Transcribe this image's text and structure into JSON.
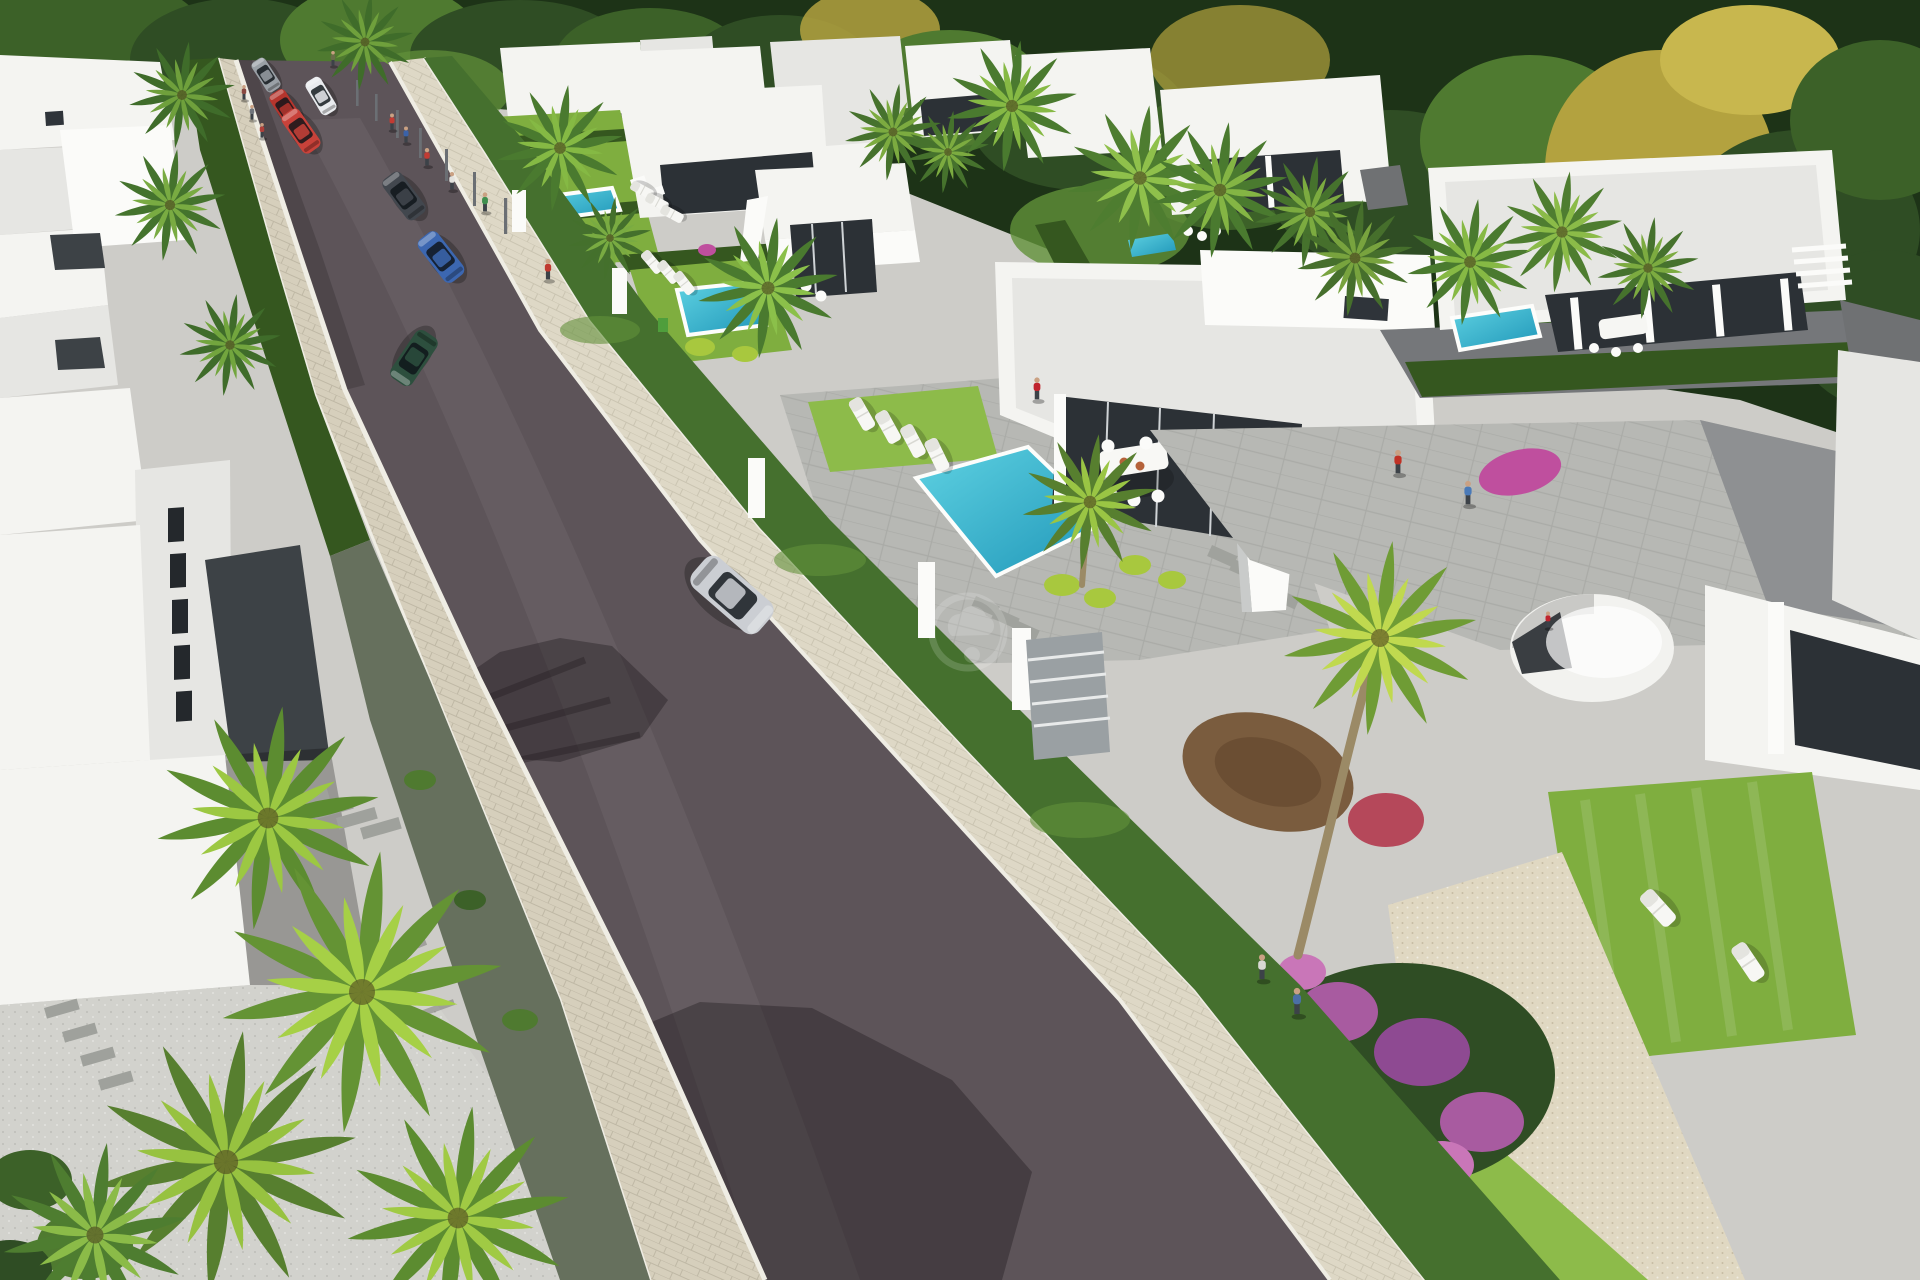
{
  "image": {
    "kind": "architectural-3d-render",
    "description": "Aerial rendering of a modern white villa development: diagonal street with cars and pedestrians, hedge-fenced lots with turquoise pools, sun loungers, palm trees, forest backdrop, faint circular watermark in center"
  },
  "palette": {
    "ground": "#cdccc8",
    "road": "#5d5459",
    "curb": "#efede4",
    "cobble": "#d6cfbc",
    "cobble-light": "#ded8c6",
    "white": "#f4f4f1",
    "white-hi": "#fbfbf9",
    "white-dim": "#e6e6e3",
    "glass": "#2c3136",
    "dark-court": "#3d4246",
    "mullion": "#cfd3d6",
    "hedge": "#45702e",
    "hedge-dark": "#35571f",
    "lawn": "#7fae3f",
    "lawn-bright": "#8dbb4a",
    "lime": "#a8c83e",
    "pool-top": "#5fd2e2",
    "pool-deep": "#1f96b8",
    "pool-coping": "#fdfdfb",
    "stone": "#66705d",
    "patio": "#b7b8b4",
    "gravel": "#e0d8c2",
    "dirt": "#7a5c3e",
    "trunk": "#9b8a66",
    "forest-1": "#1d3317",
    "forest-2": "#2f4d24",
    "forest-3": "#3c6128",
    "forest-4": "#4f7a30",
    "forest-5": "#62913a",
    "autumn-1": "#b3a23f",
    "autumn-2": "#c8b74e",
    "flower-purple": "#a85ba0",
    "flower-magenta": "#bf4f9e",
    "flower-pink": "#c976b8",
    "shadow": "rgba(25,20,24,0.35)",
    "watermark": "rgba(255,255,255,0.16)"
  },
  "scene": {
    "sprites": [
      {
        "n": "palm-tree",
        "s": "palm",
        "x": 365,
        "y": 42,
        "k": 1.0,
        "c1": "#3f6c2a",
        "c2": "#6fa03c"
      },
      {
        "n": "palm-tree",
        "s": "palm",
        "x": 182,
        "y": 95,
        "k": 1.1,
        "c1": "#3f6c2a",
        "c2": "#6fa03c"
      },
      {
        "n": "palm-tree",
        "s": "palm",
        "x": 170,
        "y": 205,
        "k": 1.15,
        "c1": "#44732d",
        "c2": "#79ab42"
      },
      {
        "n": "palm-tree",
        "s": "palm",
        "x": 230,
        "y": 345,
        "k": 1.05,
        "c1": "#3f6c2a",
        "c2": "#72a53e"
      },
      {
        "n": "palm-tree",
        "s": "palm",
        "x": 560,
        "y": 148,
        "k": 1.3,
        "c1": "#4a7a2f",
        "c2": "#85b944"
      },
      {
        "n": "palm-tree",
        "s": "palm",
        "x": 610,
        "y": 238,
        "k": 0.85,
        "c1": "#44702c",
        "c2": "#79ab42"
      },
      {
        "n": "palm-tree",
        "s": "palm",
        "x": 768,
        "y": 288,
        "k": 1.45,
        "c1": "#4a7a2f",
        "c2": "#8bc04a"
      },
      {
        "n": "palm-tree",
        "s": "palm",
        "x": 893,
        "y": 132,
        "k": 1.0,
        "c1": "#46722d",
        "c2": "#7cab40"
      },
      {
        "n": "palm-tree",
        "s": "palm",
        "x": 948,
        "y": 152,
        "k": 0.85,
        "c1": "#46722d",
        "c2": "#7cab40"
      },
      {
        "n": "palm-tree",
        "s": "palm",
        "x": 1012,
        "y": 106,
        "k": 1.35,
        "c1": "#4a7a2f",
        "c2": "#86b944"
      },
      {
        "n": "palm-tree",
        "s": "palm",
        "x": 1140,
        "y": 178,
        "k": 1.5,
        "c1": "#4e7d30",
        "c2": "#8fc04b"
      },
      {
        "n": "palm-tree",
        "s": "palm",
        "x": 1220,
        "y": 190,
        "k": 1.4,
        "c1": "#4a7a2f",
        "c2": "#84b544"
      },
      {
        "n": "palm-tree",
        "s": "palm",
        "x": 1310,
        "y": 212,
        "k": 1.15,
        "c1": "#46722d",
        "c2": "#7cab40"
      },
      {
        "n": "palm-tree",
        "s": "palm",
        "x": 1355,
        "y": 258,
        "k": 1.2,
        "c1": "#466f2c",
        "c2": "#78a33e"
      },
      {
        "n": "palm-tree",
        "s": "palm",
        "x": 1470,
        "y": 262,
        "k": 1.3,
        "c1": "#4a7a2f",
        "c2": "#86b944"
      },
      {
        "n": "palm-tree",
        "s": "palm",
        "x": 1562,
        "y": 232,
        "k": 1.25,
        "c1": "#4e7d30",
        "c2": "#8bbb48"
      },
      {
        "n": "palm-tree",
        "s": "palm",
        "x": 1648,
        "y": 268,
        "k": 1.05,
        "c1": "#46722d",
        "c2": "#7cab40"
      },
      {
        "n": "palm-tree",
        "s": "palm",
        "x": 1090,
        "y": 502,
        "k": 1.4,
        "c1": "#577f2f",
        "c2": "#9ac544"
      },
      {
        "n": "palm-tree",
        "s": "palm",
        "x": 1380,
        "y": 638,
        "k": 2.0,
        "c1": "#6f9c35",
        "c2": "#c0d94f"
      },
      {
        "n": "palm-tree",
        "s": "palm",
        "x": 268,
        "y": 818,
        "k": 2.3,
        "c1": "#5c8c30",
        "c2": "#9cc842"
      },
      {
        "n": "palm-tree",
        "s": "palm",
        "x": 362,
        "y": 992,
        "k": 2.9,
        "c1": "#649334",
        "c2": "#a6d046"
      },
      {
        "n": "palm-tree",
        "s": "palm",
        "x": 226,
        "y": 1162,
        "k": 2.7,
        "c1": "#577f2f",
        "c2": "#97c240"
      },
      {
        "n": "palm-tree",
        "s": "palm",
        "x": 458,
        "y": 1218,
        "k": 2.3,
        "c1": "#5c8c30",
        "c2": "#a0ca44"
      },
      {
        "n": "palm-tree",
        "s": "palm",
        "x": 95,
        "y": 1235,
        "k": 1.9,
        "c1": "#4e7d30",
        "c2": "#8bbb48"
      },
      {
        "n": "car-gray",
        "s": "car",
        "x": 266,
        "y": 75,
        "r": -33,
        "k": 0.42,
        "c1": "#9aa0a6"
      },
      {
        "n": "car-red-sedan",
        "s": "car",
        "x": 286,
        "y": 109,
        "r": -33,
        "k": 0.48,
        "c1": "#b5352d"
      },
      {
        "n": "car-red-suv",
        "s": "car",
        "x": 301,
        "y": 131,
        "r": -35,
        "k": 0.55,
        "c1": "#c8423a"
      },
      {
        "n": "car-white",
        "s": "car",
        "x": 321,
        "y": 96,
        "r": -31,
        "k": 0.46,
        "c1": "#e9ebee"
      },
      {
        "n": "car-dark-gray",
        "s": "car",
        "x": 404,
        "y": 196,
        "r": -37,
        "k": 0.6,
        "c1": "#42474e"
      },
      {
        "n": "car-blue",
        "s": "car",
        "x": 441,
        "y": 257,
        "r": -38,
        "k": 0.64,
        "c1": "#3c67b1"
      },
      {
        "n": "car-green-convertible",
        "s": "car",
        "x": 414,
        "y": 358,
        "r": 214,
        "k": 0.68,
        "c1": "#2d4f3e"
      },
      {
        "n": "car-silver-suv",
        "s": "car",
        "x": 732,
        "y": 595,
        "r": 131,
        "k": 1.05,
        "c1": "#cbced3"
      },
      {
        "n": "pedestrian",
        "s": "person",
        "x": 333,
        "y": 66,
        "k": 0.5,
        "c1": "#6a6d4a"
      },
      {
        "n": "pedestrian",
        "s": "person",
        "x": 244,
        "y": 100,
        "k": 0.5,
        "c1": "#8a4a42"
      },
      {
        "n": "pedestrian",
        "s": "person",
        "x": 252,
        "y": 120,
        "k": 0.5,
        "c1": "#70757c"
      },
      {
        "n": "pedestrian",
        "s": "person",
        "x": 262,
        "y": 138,
        "k": 0.5,
        "c1": "#b0403a"
      },
      {
        "n": "pedestrian",
        "s": "person",
        "x": 392,
        "y": 130,
        "k": 0.55,
        "c1": "#c23b33"
      },
      {
        "n": "pedestrian",
        "s": "person",
        "x": 406,
        "y": 143,
        "k": 0.55,
        "c1": "#3b62a8"
      },
      {
        "n": "pedestrian",
        "s": "person",
        "x": 427,
        "y": 166,
        "k": 0.6,
        "c1": "#c23b33"
      },
      {
        "n": "pedestrian",
        "s": "person",
        "x": 452,
        "y": 190,
        "k": 0.6,
        "c1": "#e2e2de"
      },
      {
        "n": "pedestrian",
        "s": "person",
        "x": 485,
        "y": 212,
        "k": 0.65,
        "c1": "#3f8f4e"
      },
      {
        "n": "pedestrian",
        "s": "person",
        "x": 548,
        "y": 280,
        "k": 0.7,
        "c1": "#c0392f"
      },
      {
        "n": "woman-by-pool",
        "s": "person",
        "x": 1037,
        "y": 400,
        "k": 0.75,
        "c1": "#c0242e"
      },
      {
        "n": "man-red-shirt",
        "s": "person",
        "x": 1398,
        "y": 474,
        "k": 0.8,
        "c1": "#c03226"
      },
      {
        "n": "man-blue-shirt",
        "s": "person",
        "x": 1468,
        "y": 505,
        "k": 0.8,
        "c1": "#4a7ab8"
      },
      {
        "n": "figure-in-dome",
        "s": "person",
        "x": 1548,
        "y": 628,
        "k": 0.55,
        "c1": "#c0242e"
      },
      {
        "n": "walker-white",
        "s": "person",
        "x": 1262,
        "y": 980,
        "k": 0.85,
        "c1": "#d9d9d3"
      },
      {
        "n": "walker-blue",
        "s": "person",
        "x": 1297,
        "y": 1015,
        "k": 0.9,
        "c1": "#4b6fa5"
      },
      {
        "n": "sun-lounger",
        "s": "lounger",
        "x": 642,
        "y": 190,
        "r": -62,
        "k": 0.7
      },
      {
        "n": "sun-lounger",
        "s": "lounger",
        "x": 657,
        "y": 202,
        "r": -62,
        "k": 0.7
      },
      {
        "n": "sun-lounger",
        "s": "lounger",
        "x": 672,
        "y": 214,
        "r": -62,
        "k": 0.7
      },
      {
        "n": "sun-lounger",
        "s": "lounger",
        "x": 652,
        "y": 262,
        "r": -40,
        "k": 0.75
      },
      {
        "n": "sun-lounger",
        "s": "lounger",
        "x": 668,
        "y": 272,
        "r": -40,
        "k": 0.75
      },
      {
        "n": "sun-lounger",
        "s": "lounger",
        "x": 684,
        "y": 283,
        "r": -38,
        "k": 0.75
      },
      {
        "n": "sun-lounger",
        "s": "lounger",
        "x": 862,
        "y": 414,
        "r": -30,
        "k": 1.0
      },
      {
        "n": "sun-lounger",
        "s": "lounger",
        "x": 888,
        "y": 427,
        "r": -29,
        "k": 1.0
      },
      {
        "n": "sun-lounger",
        "s": "lounger",
        "x": 913,
        "y": 441,
        "r": -28,
        "k": 1.0
      },
      {
        "n": "sun-lounger",
        "s": "lounger",
        "x": 937,
        "y": 455,
        "r": -26,
        "k": 1.0
      },
      {
        "n": "sun-lounger",
        "s": "lounger",
        "x": 1658,
        "y": 908,
        "r": -42,
        "k": 1.2
      },
      {
        "n": "sun-lounger",
        "s": "lounger",
        "x": 1748,
        "y": 962,
        "r": -34,
        "k": 1.2
      }
    ]
  }
}
